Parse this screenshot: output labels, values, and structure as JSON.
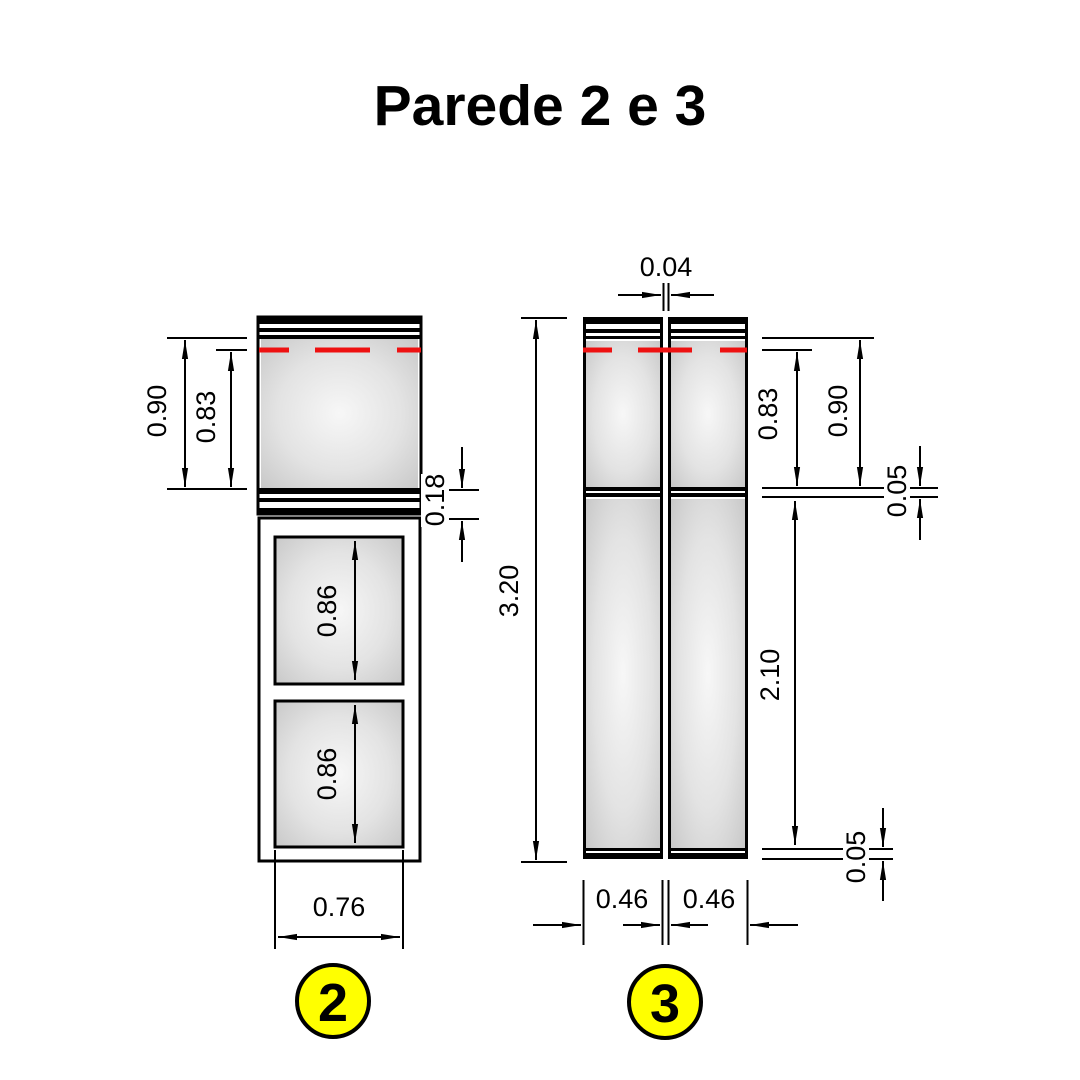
{
  "title": "Parede 2 e 3",
  "walls": {
    "left": {
      "badge": "2",
      "dims": {
        "upper_height_total": "0.90",
        "upper_height_to_marker": "0.83",
        "spacer_band": "0.18",
        "opening_upper": "0.86",
        "opening_lower": "0.86",
        "width": "0.76"
      }
    },
    "right": {
      "badge": "3",
      "dims": {
        "top_gap": "0.04",
        "total_height": "3.20",
        "upper_height_to_marker": "0.83",
        "upper_height_total": "0.90",
        "upper_band": "0.05",
        "lower_height": "2.10",
        "lower_band": "0.05",
        "left_panel_width": "0.46",
        "right_panel_width": "0.46"
      }
    }
  },
  "colors": {
    "marker_line": "#ee1111",
    "badge_fill": "#ffff00",
    "line_black": "#000000"
  }
}
